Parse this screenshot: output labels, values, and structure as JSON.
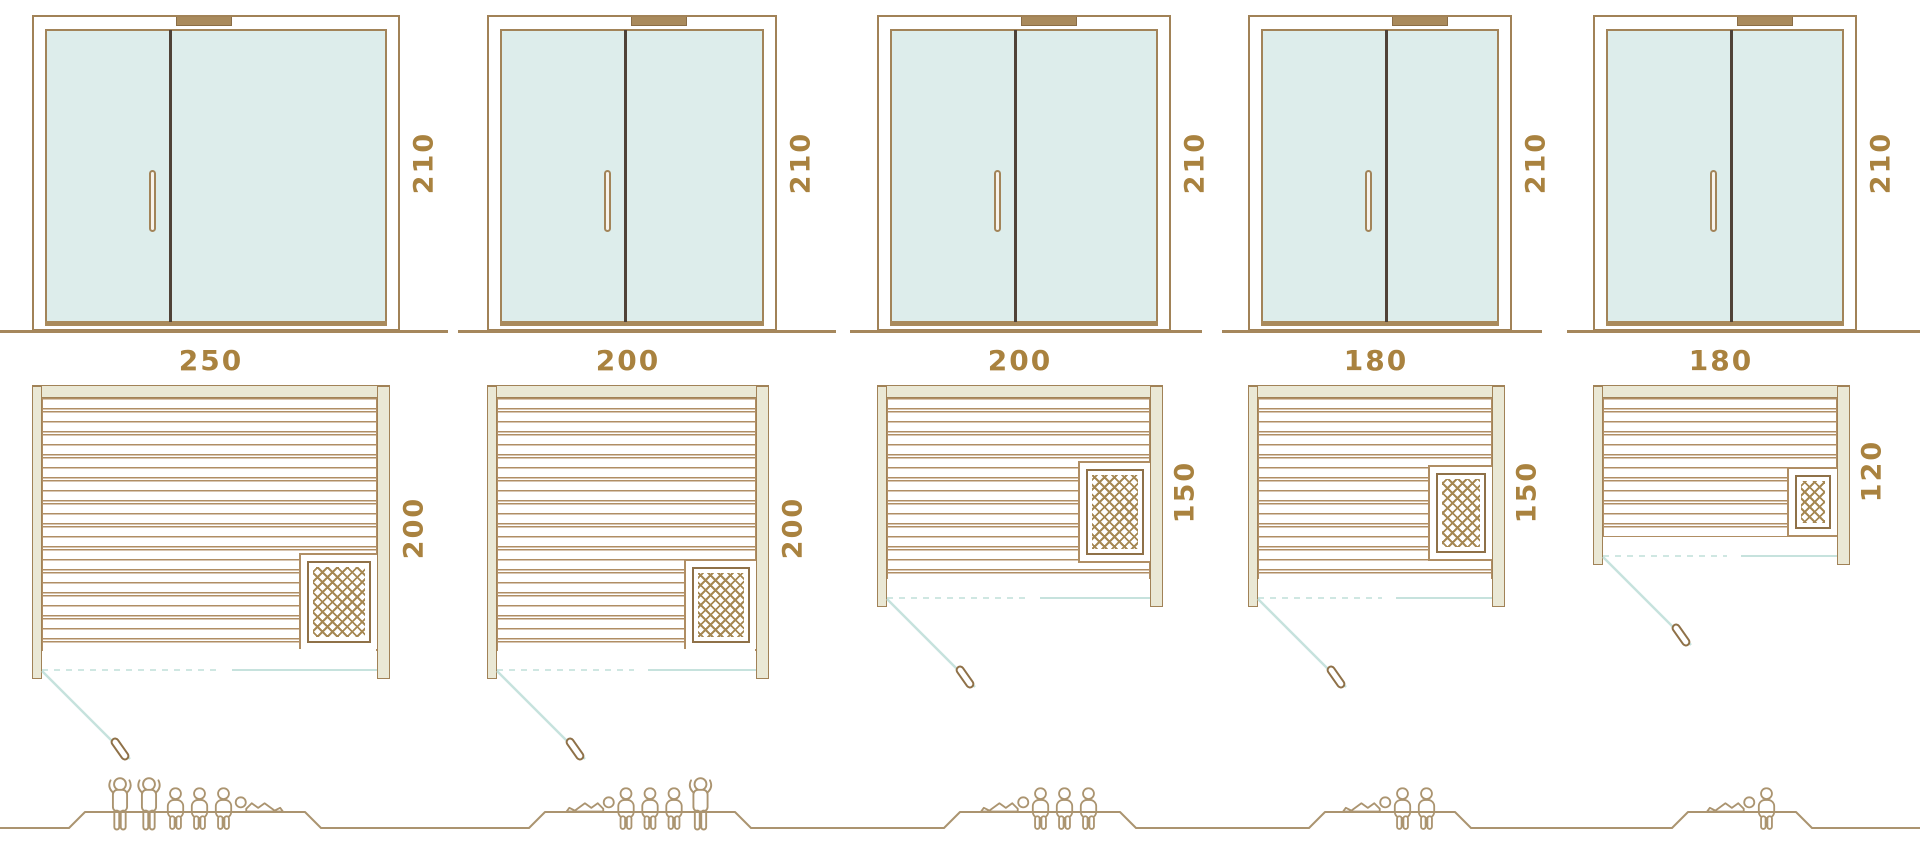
{
  "diagram_title": "",
  "unit_note": "",
  "door_height_cm": "210",
  "columns": [
    {
      "model": "250 x 200",
      "height_label": "210",
      "width_label": "250",
      "depth_label": "200",
      "capacity": 6,
      "people": [
        "standing",
        "standing",
        "sitting",
        "sitting",
        "sitting",
        "lying-flipped"
      ]
    },
    {
      "model": "200 x 200",
      "height_label": "210",
      "width_label": "200",
      "depth_label": "200",
      "capacity": 5,
      "people": [
        "lying",
        "sitting",
        "sitting",
        "sitting",
        "standing"
      ]
    },
    {
      "model": "200 x 150",
      "height_label": "210",
      "width_label": "200",
      "depth_label": "150",
      "capacity": 4,
      "people": [
        "lying",
        "sitting",
        "sitting",
        "sitting"
      ]
    },
    {
      "model": "180 x 150",
      "height_label": "210",
      "width_label": "180",
      "depth_label": "150",
      "capacity": 3,
      "people": [
        "lying",
        "sitting",
        "sitting"
      ]
    },
    {
      "model": "180 x 120",
      "height_label": "210",
      "width_label": "180",
      "depth_label": "120",
      "capacity": 2,
      "people": [
        "lying",
        "sitting"
      ]
    }
  ],
  "colors": {
    "tan": "#a18257",
    "slat": "#b08e64",
    "beige": "#eae8d5",
    "glass": "#ddedeb",
    "divider": "#4f4237",
    "brown": "#a98a5c",
    "gold": "#a9823f",
    "teal": "#c6e2dd",
    "people": "#ab9470",
    "heat": "#a68853"
  }
}
